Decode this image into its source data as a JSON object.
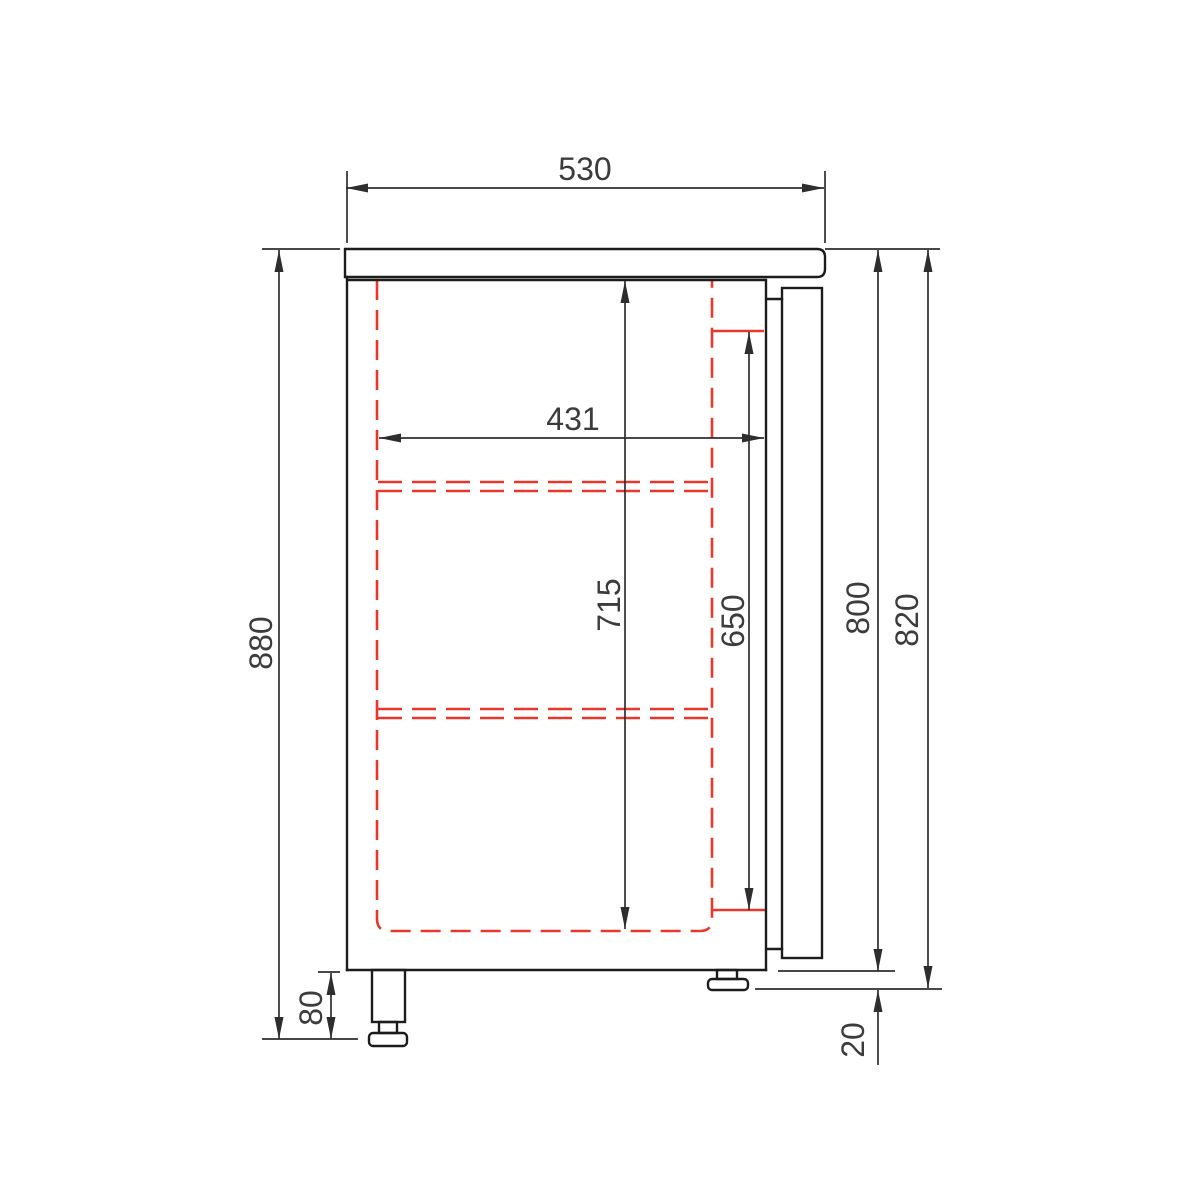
{
  "drawing": {
    "dimensions": {
      "top_width": "530",
      "overall_height": "880",
      "leg_height": "80",
      "interior_width": "431",
      "interior_height": "715",
      "door_height": "650",
      "body_height": "800",
      "body_plus_clearance_height": "820",
      "foot_clearance": "20"
    },
    "colors": {
      "outline": "#1c1c1c",
      "dimension": "#2e2e2e",
      "hidden_line": "#e8382c",
      "background": "#ffffff"
    }
  }
}
